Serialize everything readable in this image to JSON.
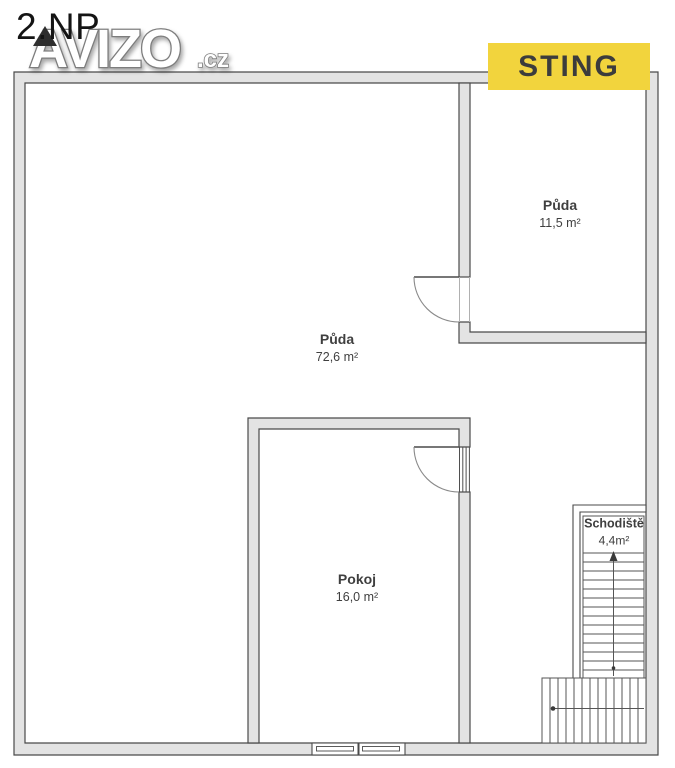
{
  "page": {
    "title": "2.NP"
  },
  "watermark": {
    "text": "AVIZO",
    "suffix": ".cz"
  },
  "badge": {
    "text": "STING",
    "bg": "#F2D43D",
    "fg": "#3C3C3C"
  },
  "rooms": [
    {
      "id": "puda-small",
      "name": "Půda",
      "area": "11,5 m²"
    },
    {
      "id": "puda-large",
      "name": "Půda",
      "area": "72,6 m²"
    },
    {
      "id": "pokoj",
      "name": "Pokoj",
      "area": "16,0 m²"
    },
    {
      "id": "schodiste",
      "name": "Schodiště",
      "area": "4,4m²"
    }
  ],
  "colors": {
    "wall_fill": "#e3e3e3",
    "wall_stroke": "#4a4a4a",
    "label_text": "#3f3f3f",
    "badge_bg": "#F2D43D"
  }
}
